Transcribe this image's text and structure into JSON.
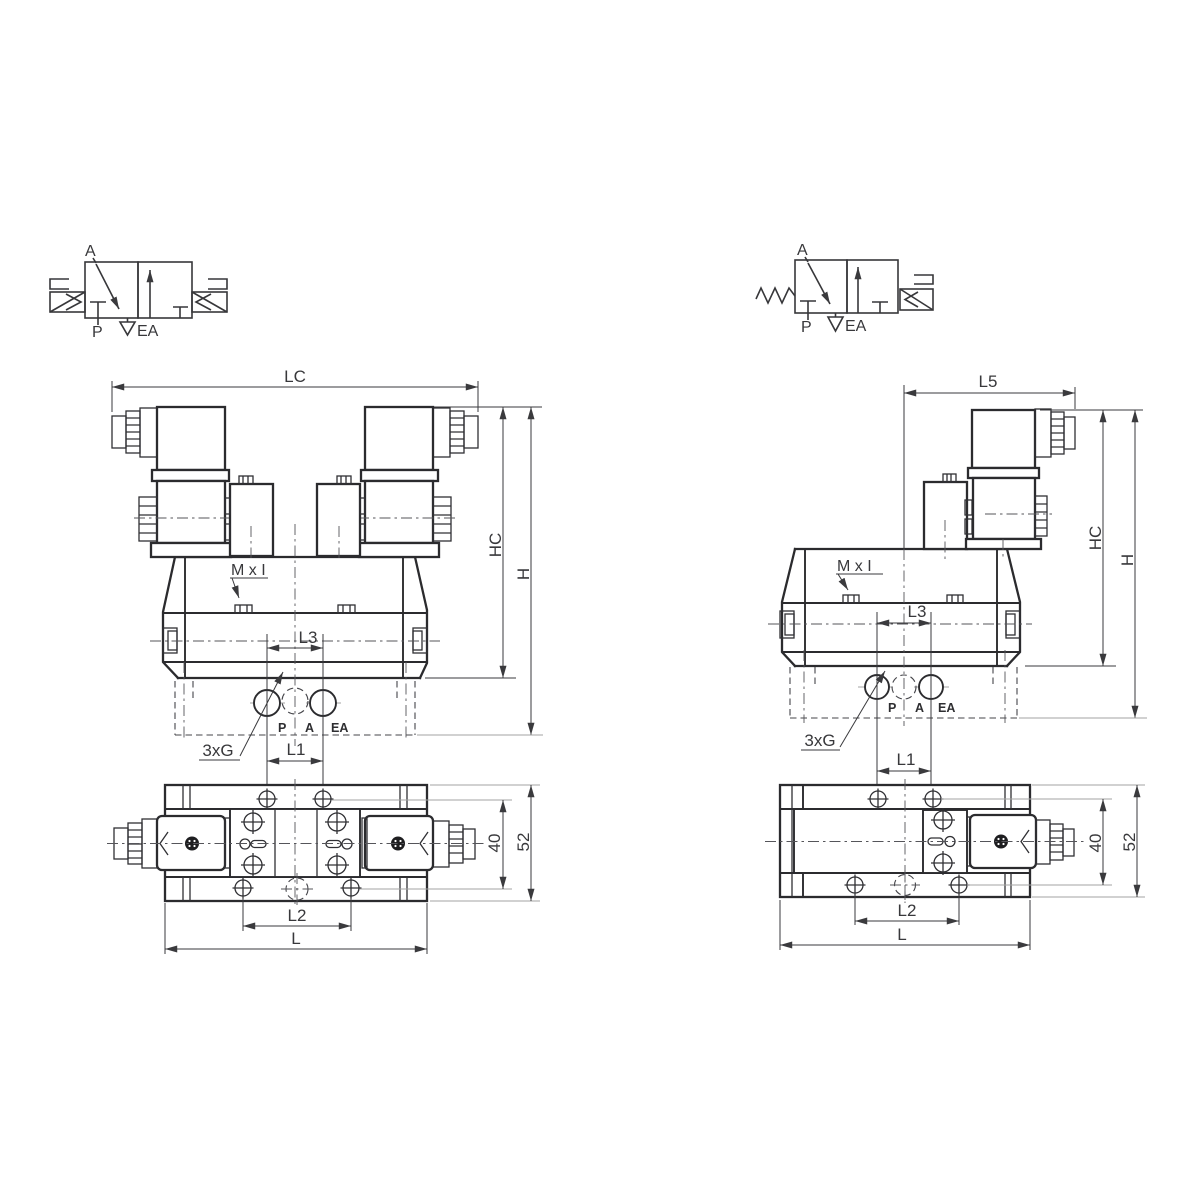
{
  "page": {
    "title": "Solenoid valve dimensional drawing",
    "background": "#ffffff"
  },
  "colors": {
    "line": "#2b2b2e",
    "dim_line": "#3a3a3d",
    "ref_line": "#a3a3a3",
    "text": "#38383b"
  },
  "left_drawing": {
    "symbol": {
      "a": "A",
      "p": "P",
      "ea": "EA"
    },
    "front": {
      "width_dim": "LC",
      "coil_height_dim": "HC",
      "height_dim": "H",
      "mounting_thread": "M x I",
      "port_pitch_dim": "L3",
      "port_size": "3xG",
      "port_p": "P",
      "port_a": "A",
      "port_ea": "EA"
    },
    "bottom": {
      "hole_pitch_dim": "L1",
      "slot_pitch_dim": "L2",
      "length_dim": "L",
      "width_dim": "40",
      "overall_width_dim": "52"
    }
  },
  "right_drawing": {
    "symbol": {
      "a": "A",
      "p": "P",
      "ea": "EA"
    },
    "front": {
      "width_dim": "L5",
      "coil_height_dim": "HC",
      "height_dim": "H",
      "mounting_thread": "M x I",
      "port_pitch_dim": "L3",
      "port_size": "3xG",
      "port_p": "P",
      "port_a": "A",
      "port_ea": "EA"
    },
    "bottom": {
      "hole_pitch_dim": "L1",
      "slot_pitch_dim": "L2",
      "length_dim": "L",
      "width_dim": "40",
      "overall_width_dim": "52"
    }
  }
}
